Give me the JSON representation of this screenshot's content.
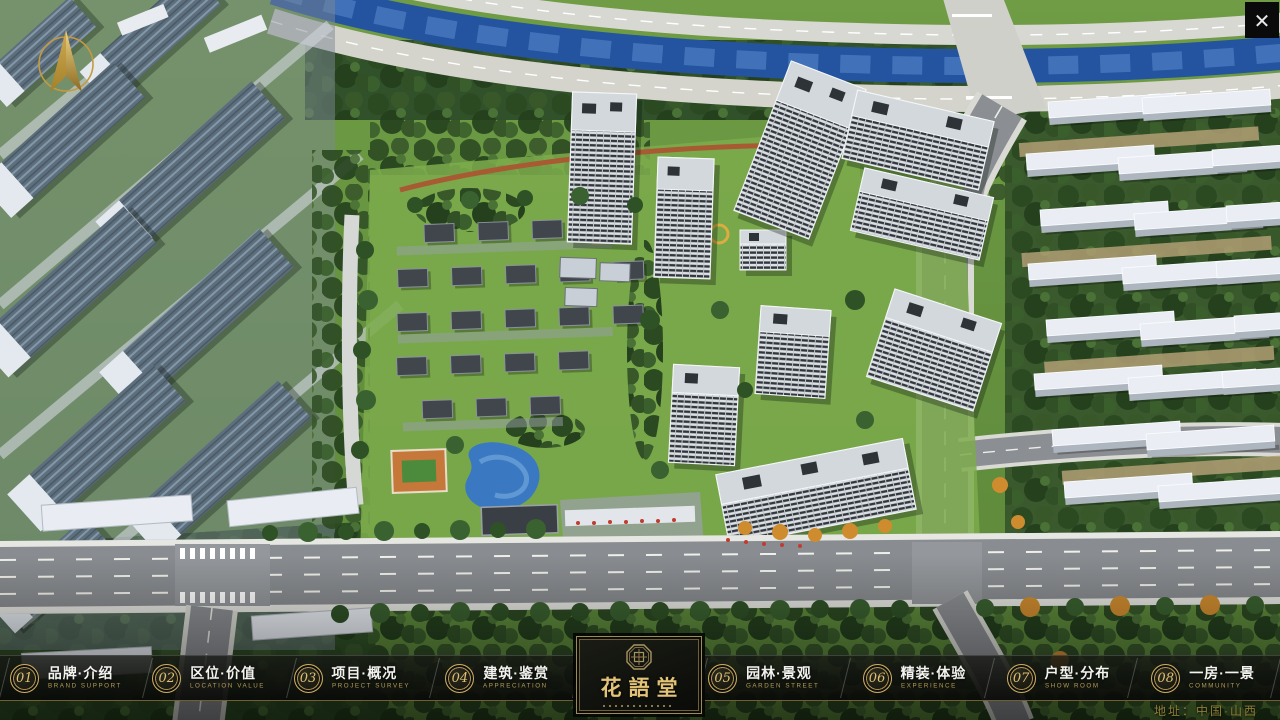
{
  "nav": {
    "items": [
      {
        "num": "01",
        "label": "品牌·介绍",
        "sub": "BRAND SUPPORT"
      },
      {
        "num": "02",
        "label": "区位·价值",
        "sub": "LOCATION VALUE"
      },
      {
        "num": "03",
        "label": "项目·概况",
        "sub": "PROJECT SURVEY"
      },
      {
        "num": "04",
        "label": "建筑·鉴赏",
        "sub": "APPRECIATION"
      },
      {
        "num": "05",
        "label": "园林·景观",
        "sub": "GARDEN STREET"
      },
      {
        "num": "06",
        "label": "精装·体验",
        "sub": "EXPERIENCE"
      },
      {
        "num": "07",
        "label": "户型·分布",
        "sub": "SHOW ROOM"
      },
      {
        "num": "08",
        "label": "一房·一景",
        "sub": "COMMUNITY"
      }
    ]
  },
  "logo": {
    "title": "花語堂"
  },
  "footer": {
    "address": "地址：中国·山西"
  },
  "icons": {
    "close": "✕"
  },
  "colors": {
    "gold": "#cfae62",
    "gold_dark": "#6e5f35",
    "bar_bg": "#0c0d0a",
    "text": "#f2f2ee"
  }
}
